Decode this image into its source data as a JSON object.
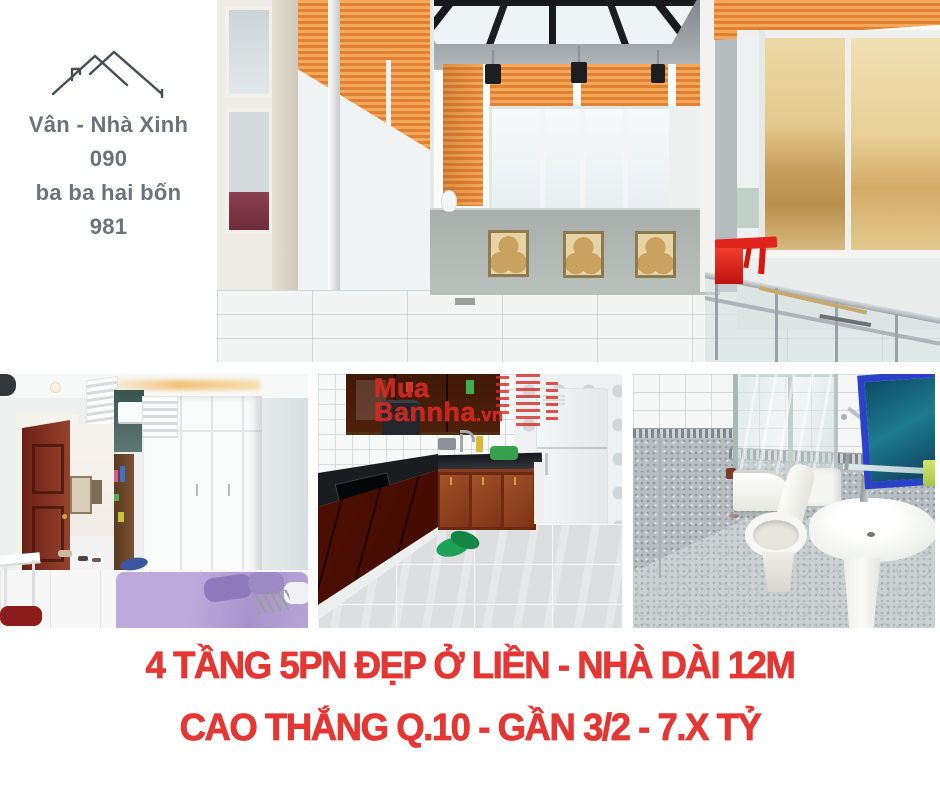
{
  "contact_card": {
    "brand": "Vân - Nhà Xinh",
    "phone_line1": "090",
    "phone_line2": "ba ba hai bốn",
    "phone_line3": "981"
  },
  "watermark": {
    "line1": "Mua",
    "line2": "Bannha",
    "domain_suffix": ".vn"
  },
  "headline": {
    "line1": "4 TẦNG 5PN ĐẸP Ở LIỀN - NHÀ DÀI 12M",
    "line2": "CAO THẮNG Q.10 - GẦN 3/2 - 7.X TỶ"
  },
  "palette": {
    "headline_red": "#e43734",
    "contact_gray": "#6d727a",
    "watermark_red": "#d72a23",
    "blind_orange": "#ef9a4a",
    "cabinet_wood": "#8a3a1d",
    "mirror_blue": "#2b41c9",
    "bed_purple": "#b4a3d8",
    "table_red": "#e0241b"
  }
}
